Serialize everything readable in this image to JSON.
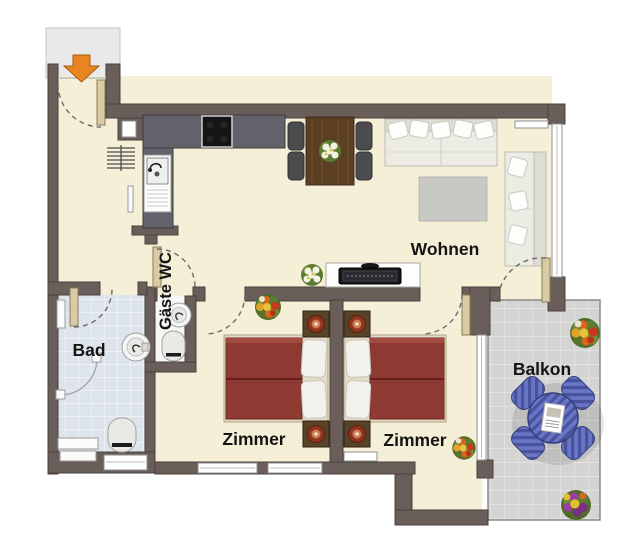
{
  "page": {
    "kind": "apartment-floor-plan",
    "language": "de",
    "background": "#ffffff"
  },
  "labels": {
    "living": "Wohnen",
    "bath": "Bad",
    "guest_wc": "Gäste WC",
    "bedroom1": "Zimmer",
    "bedroom2": "Zimmer",
    "balcony": "Balkon"
  },
  "entrance": {
    "icon": "entrance-arrow-down-icon",
    "color": "#e8851e"
  },
  "colors": {
    "wall": "#695e5a",
    "floor": "#f6efd8",
    "vestibule": "#e9e9e9",
    "bath_tile": "#dde4ec",
    "balcony_tile": "#d4d4d2",
    "bed_cover": "#8e3a33",
    "kitchen_counter": "#62626a",
    "cooktop": "#151515",
    "balcony_furniture": "#5561b4",
    "door_leaf": "#d9cba6",
    "label_text": "#141414",
    "sofa": "#ecebe4",
    "rug": "#c8c8c5",
    "dining_table": "#5a3f22"
  },
  "furniture_icons": [
    "entrance-arrow-down-icon",
    "kitchen-counter",
    "cooktop",
    "kitchen-sink",
    "radiator",
    "dining-table",
    "dining-chair",
    "flower-bouquet",
    "sofa",
    "wall-shelf",
    "rug",
    "sideboard",
    "tv",
    "bed",
    "pillow",
    "nightstand",
    "washbasin",
    "toilet",
    "shower-door",
    "bath-shelf",
    "balcony-table",
    "balcony-chair",
    "magazine",
    "window",
    "door-swing-arc",
    "door-leaf"
  ]
}
